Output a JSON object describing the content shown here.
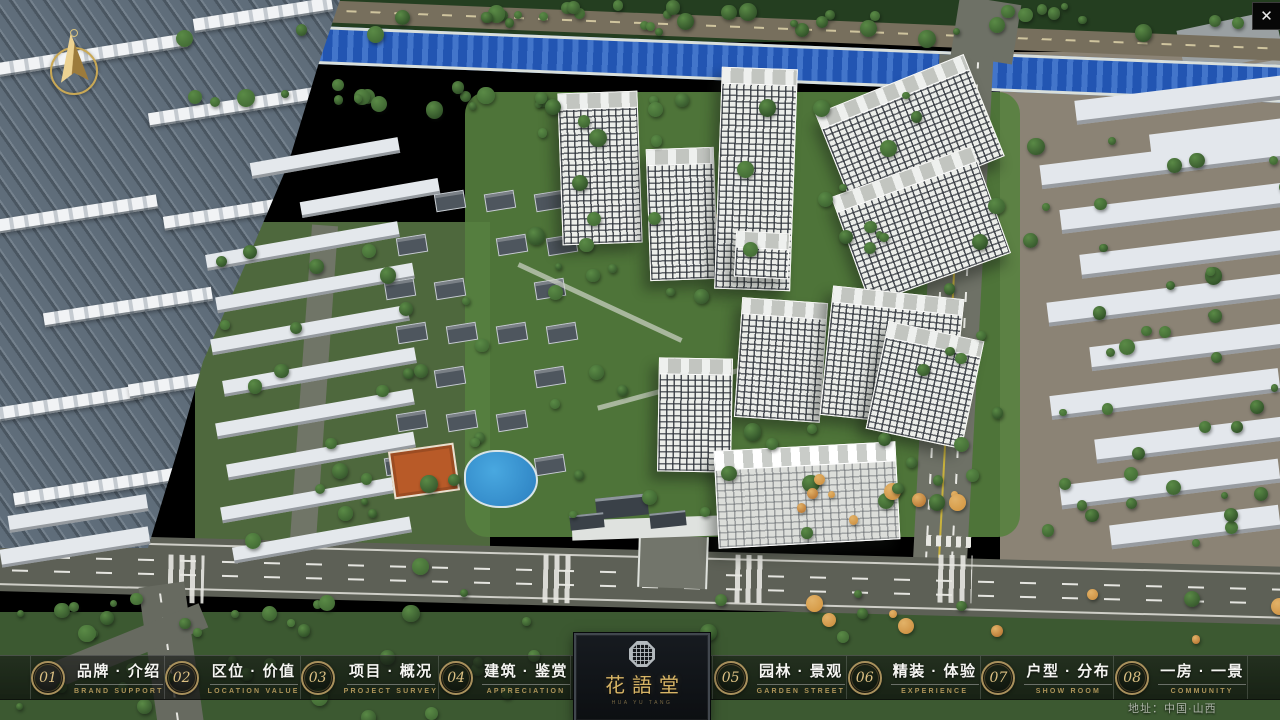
{
  "window": {
    "close_icon": "✕"
  },
  "nav": {
    "items": [
      {
        "num": "01",
        "label": "品牌 · 介绍",
        "caption": "BRAND SUPPORT"
      },
      {
        "num": "02",
        "label": "区位 · 价值",
        "caption": "LOCATION VALUE"
      },
      {
        "num": "03",
        "label": "项目 · 概况",
        "caption": "PROJECT SURVEY"
      },
      {
        "num": "04",
        "label": "建筑 · 鉴赏",
        "caption": "APPRECIATION"
      },
      {
        "num": "05",
        "label": "园林 · 景观",
        "caption": "GARDEN STREET"
      },
      {
        "num": "06",
        "label": "精装 · 体验",
        "caption": "EXPERIENCE"
      },
      {
        "num": "07",
        "label": "户型 · 分布",
        "caption": "SHOW ROOM"
      },
      {
        "num": "08",
        "label": "一房 · 一景",
        "caption": "COMMUNITY"
      }
    ]
  },
  "logo": {
    "title": "花語堂",
    "subtitle": "HUA YU TANG"
  },
  "footer": {
    "address": "地址：中国·山西"
  },
  "colors": {
    "accent_gold": "#c9a85c",
    "caption_gold": "#ad9459",
    "nav_text": "#f5f5f2"
  }
}
